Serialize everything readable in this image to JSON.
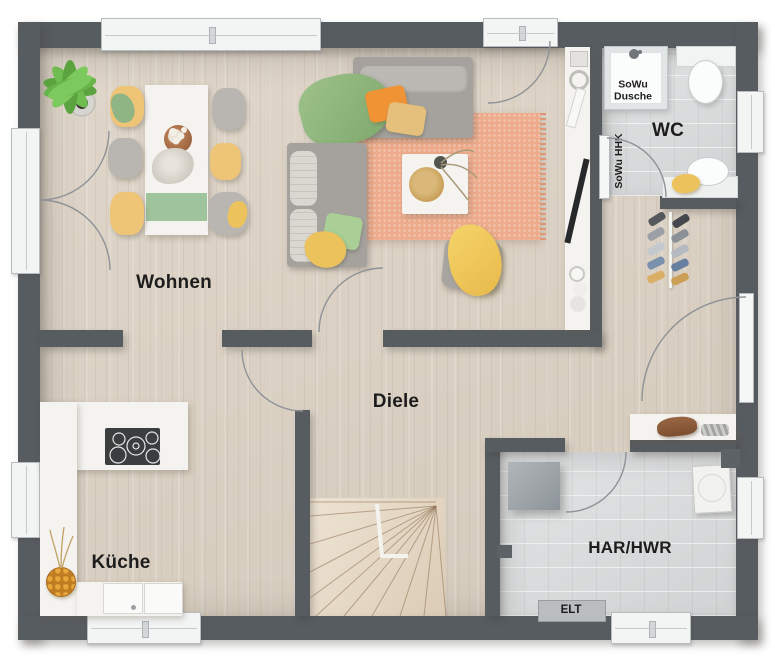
{
  "rooms": {
    "wohnen": {
      "label": "Wohnen"
    },
    "kueche": {
      "label": "Küche"
    },
    "diele": {
      "label": "Diele"
    },
    "wc": {
      "label": "WC"
    },
    "har_hwr": {
      "label": "HAR/HWR"
    }
  },
  "annotations": {
    "shower": {
      "line1": "SoWu",
      "line2": "Dusche"
    },
    "heating": {
      "label": "SoWu HHK"
    },
    "electrical": {
      "label": "ELT"
    }
  },
  "colors": {
    "wall": "#575c61",
    "wood_floor": "#dcd2c4",
    "tile_floor": "#d9dbdc",
    "stair_wood": "#e7d9c4",
    "rug_salmon": "#edab8b",
    "accent_yellow": "#eec477",
    "accent_green": "#9fc39b",
    "accent_orange": "#ef9335",
    "furniture_white": "#f4f3f0",
    "sofa_grey": "#a5a29e"
  }
}
